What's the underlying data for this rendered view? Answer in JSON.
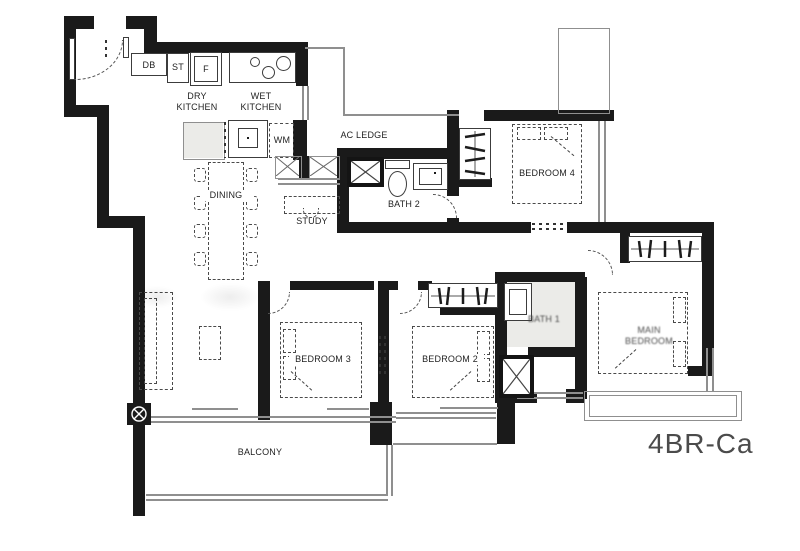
{
  "plan": {
    "code": "4BR-Ca",
    "rooms": {
      "dry_kitchen": "DRY KITCHEN",
      "wet_kitchen": "WET KITCHEN",
      "ac_ledge": "AC LEDGE",
      "dining": "DINING",
      "study": "STUDY",
      "bath2": "BATH 2",
      "bedroom4": "BEDROOM 4",
      "bedroom3": "BEDROOM 3",
      "bedroom2": "BEDROOM 2",
      "bath1": "BATH 1",
      "main_bedroom": "MAIN BEDROOM",
      "balcony": "BALCONY"
    },
    "fixtures": {
      "db": "DB",
      "st": "ST",
      "f": "F",
      "wm": "WM"
    },
    "colors": {
      "wall": "#1a1a1a",
      "thin_line": "#8f8f8f",
      "label_text": "#1f1f1f",
      "plan_code_text": "#4b4b4b",
      "bath_fill": "#ebebe8"
    }
  }
}
